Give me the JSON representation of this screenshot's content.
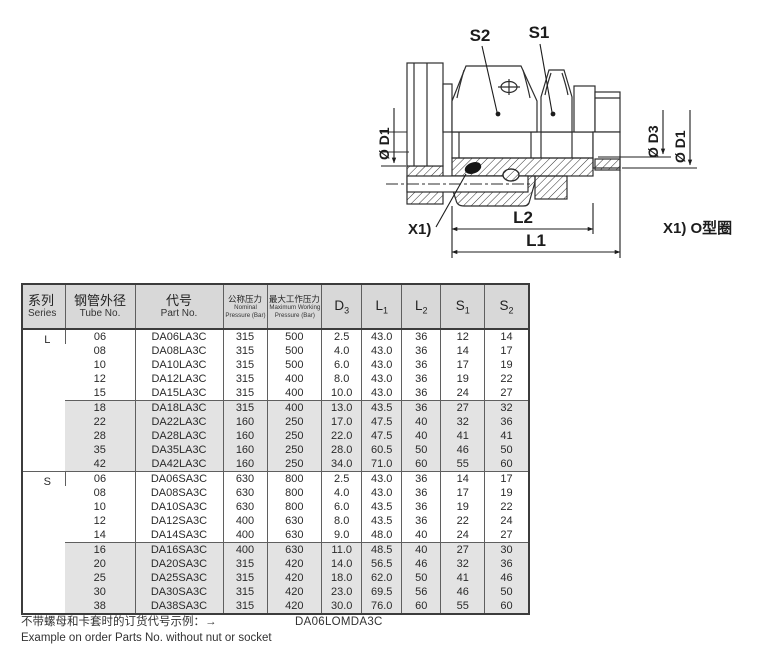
{
  "drawing": {
    "labels": {
      "s2": "S2",
      "s1": "S1",
      "dia_d1": "Ø D1",
      "dia_d3": "Ø D3",
      "l2": "L2",
      "l1": "L1",
      "x1": "X1)",
      "note": "X1) O型圈"
    }
  },
  "colors": {
    "header_bg": "#d8d8d8",
    "shaded_row_bg": "#e3e3e3",
    "line": "#2e2e2e"
  },
  "table": {
    "headers": {
      "series_zh": "系列",
      "series_en": "Series",
      "tube_zh": "钢管外径",
      "tube_en": "Tube No.",
      "part_zh": "代号",
      "part_en": "Part No.",
      "nominal_zh": "公称压力",
      "nominal_en1": "Nominal",
      "nominal_en2": "Pressure (Bar)",
      "max_zh": "最大工作压力",
      "max_en1": "Maximum Working",
      "max_en2": "Pressure (Bar)"
    },
    "dim_headers": [
      {
        "base": "D",
        "sub": "3"
      },
      {
        "base": "L",
        "sub": "1"
      },
      {
        "base": "L",
        "sub": "2"
      },
      {
        "base": "S",
        "sub": "1"
      },
      {
        "base": "S",
        "sub": "2"
      }
    ],
    "sections": [
      {
        "series": "L",
        "blocks": [
          {
            "shaded": false,
            "rows": [
              [
                "06",
                "DA06LA3C",
                "315",
                "500",
                "2.5",
                "43.0",
                "36",
                "12",
                "14"
              ],
              [
                "08",
                "DA08LA3C",
                "315",
                "500",
                "4.0",
                "43.0",
                "36",
                "14",
                "17"
              ],
              [
                "10",
                "DA10LA3C",
                "315",
                "500",
                "6.0",
                "43.0",
                "36",
                "17",
                "19"
              ],
              [
                "12",
                "DA12LA3C",
                "315",
                "400",
                "8.0",
                "43.0",
                "36",
                "19",
                "22"
              ],
              [
                "15",
                "DA15LA3C",
                "315",
                "400",
                "10.0",
                "43.0",
                "36",
                "24",
                "27"
              ]
            ]
          },
          {
            "shaded": true,
            "rows": [
              [
                "18",
                "DA18LA3C",
                "315",
                "400",
                "13.0",
                "43.5",
                "36",
                "27",
                "32"
              ],
              [
                "22",
                "DA22LA3C",
                "160",
                "250",
                "17.0",
                "47.5",
                "40",
                "32",
                "36"
              ],
              [
                "28",
                "DA28LA3C",
                "160",
                "250",
                "22.0",
                "47.5",
                "40",
                "41",
                "41"
              ],
              [
                "35",
                "DA35LA3C",
                "160",
                "250",
                "28.0",
                "60.5",
                "50",
                "46",
                "50"
              ],
              [
                "42",
                "DA42LA3C",
                "160",
                "250",
                "34.0",
                "71.0",
                "60",
                "55",
                "60"
              ]
            ]
          }
        ]
      },
      {
        "series": "S",
        "blocks": [
          {
            "shaded": false,
            "rows": [
              [
                "06",
                "DA06SA3C",
                "630",
                "800",
                "2.5",
                "43.0",
                "36",
                "14",
                "17"
              ],
              [
                "08",
                "DA08SA3C",
                "630",
                "800",
                "4.0",
                "43.0",
                "36",
                "17",
                "19"
              ],
              [
                "10",
                "DA10SA3C",
                "630",
                "800",
                "6.0",
                "43.5",
                "36",
                "19",
                "22"
              ],
              [
                "12",
                "DA12SA3C",
                "400",
                "630",
                "8.0",
                "43.5",
                "36",
                "22",
                "24"
              ],
              [
                "14",
                "DA14SA3C",
                "400",
                "630",
                "9.0",
                "48.0",
                "40",
                "24",
                "27"
              ]
            ]
          },
          {
            "shaded": true,
            "rows": [
              [
                "16",
                "DA16SA3C",
                "400",
                "630",
                "11.0",
                "48.5",
                "40",
                "27",
                "30"
              ],
              [
                "20",
                "DA20SA3C",
                "315",
                "420",
                "14.0",
                "56.5",
                "46",
                "32",
                "36"
              ],
              [
                "25",
                "DA25SA3C",
                "315",
                "420",
                "18.0",
                "62.0",
                "50",
                "41",
                "46"
              ],
              [
                "30",
                "DA30SA3C",
                "315",
                "420",
                "23.0",
                "69.5",
                "56",
                "46",
                "50"
              ],
              [
                "38",
                "DA38SA3C",
                "315",
                "420",
                "30.0",
                "76.0",
                "60",
                "55",
                "60"
              ]
            ]
          }
        ]
      }
    ]
  },
  "footer": {
    "line1": "不带螺母和卡套时的订货代号示例：→",
    "code": "DA06LOMDA3C",
    "line2": "Example on order Parts No. without nut or socket"
  }
}
